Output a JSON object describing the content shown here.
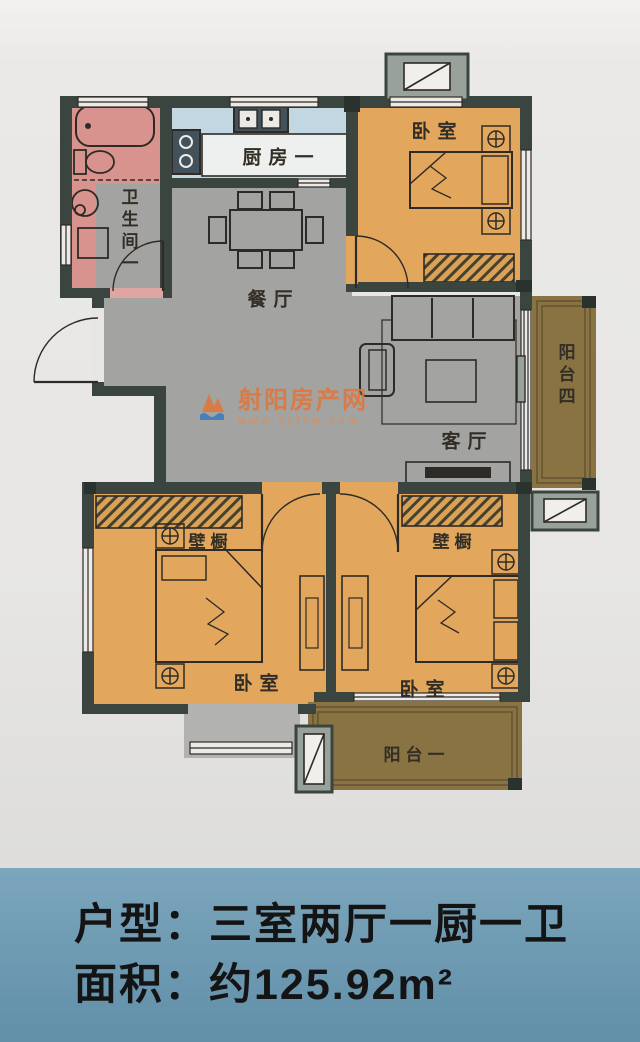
{
  "rooms": {
    "kitchen": {
      "label": "厨房一"
    },
    "bathroom": {
      "label": "卫生间一"
    },
    "dining": {
      "label": "餐厅"
    },
    "living": {
      "label": "客厅"
    },
    "bedroom_top": {
      "label": "卧室"
    },
    "bedroom_left": {
      "label": "卧室"
    },
    "bedroom_right": {
      "label": "卧室"
    },
    "closet_left": {
      "label": "壁橱"
    },
    "closet_right": {
      "label": "壁橱"
    },
    "balcony_right": {
      "label": "阳台四"
    },
    "balcony_bottom": {
      "label": "阳台一"
    }
  },
  "watermark": {
    "name": "射阳房产网",
    "url": "www.syfcw.com"
  },
  "footer": {
    "layout_line": "户型：三室两厅一厨一卫",
    "area_line": "面积：约125.92m²"
  },
  "colors": {
    "bedroom_fill": "#e2a75d",
    "bathroom_fill": "#d9938e",
    "kitchen_fill": "#c2d7e1",
    "hall_fill": "#a3a3a1",
    "balcony_fill": "#8a7343",
    "wall": "#3b453f",
    "footer_band": "#6f9bb3",
    "watermark_orange": "#e0763a"
  }
}
